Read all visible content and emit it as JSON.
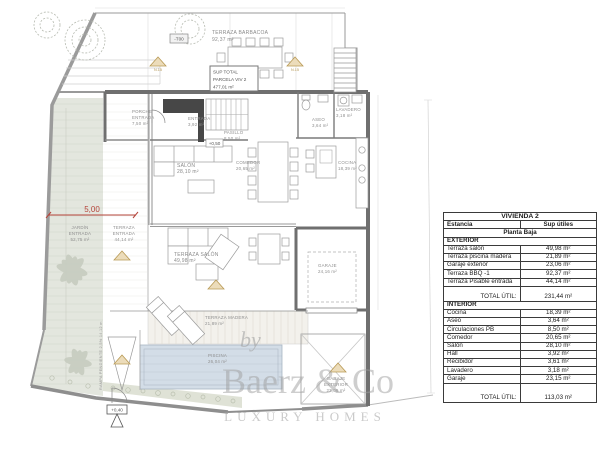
{
  "colors": {
    "wall": "#6f6f6f",
    "garden": "#e3e6de",
    "pool": "#d3dde7",
    "deck": "#f3f1ec",
    "accent_red": "#b5443a",
    "marker_tan": "#ecdcba",
    "marker_tan_edge": "#b99a55"
  },
  "plan": {
    "rooms": {
      "terraza_barbacoa": {
        "name": "TERRAZA BARBACOA",
        "area": "92,37 m²"
      },
      "porche": {
        "l1": "PORCHE",
        "l2": "ENTRADA",
        "area": "7,50 m²"
      },
      "entrada": {
        "name": "ENTRADA",
        "area": "3,92 m²"
      },
      "pasillo": {
        "name": "PASILLO",
        "area": "8,50 m²"
      },
      "salon": {
        "name": "SALÓN",
        "area": "28,10 m²"
      },
      "comedor": {
        "name": "COMEDOR",
        "area": "20,65 m²"
      },
      "cocina": {
        "name": "COCINA",
        "area": "18,39 m²"
      },
      "aseo": {
        "name": "ASEO",
        "area": "3,64 m²"
      },
      "lavadero": {
        "name": "LAVADERO",
        "area": "3,18 m²"
      },
      "jardin_entrada": {
        "l1": "JARDÍN",
        "l2": "ENTRADA",
        "area": "52,75 m²"
      },
      "terraza_entrada": {
        "l1": "TERRAZA",
        "l2": "ENTRADA",
        "area": "44,14 m²"
      },
      "terraza_salon": {
        "name": "TERRAZA SALÓN",
        "area": "49,98 m²"
      },
      "garaje": {
        "name": "GARAJE",
        "area": "24,16 m²"
      },
      "terraza_madera": {
        "name": "TERRAZA MADERA",
        "area": "21,89 m²"
      },
      "piscina": {
        "name": "PISCINA",
        "area": "26,04 m²"
      },
      "garaje_exterior": {
        "l1": "GARAJE",
        "l2": "EXTERIOR",
        "area": "23,06 m²"
      }
    },
    "markers": {
      "t00": "-T00",
      "level_plus050": "+0,50",
      "level_plus040": "+0,40",
      "dim_width": "5,00",
      "north_a": "N.15",
      "north_b": "N.15",
      "ramp_note": "RAMPA PENDIENTE 2,5% 14,12 m",
      "sup_total_l1": "SUP TOTAL",
      "sup_total_l2": "PARCELA VIV 2",
      "sup_total_l3": "477,01 m²"
    }
  },
  "watermark": {
    "by": "by",
    "brand": "Baerz & Co",
    "tagline": "LUXURY HOMES"
  },
  "table": {
    "title": "VIVIENDA 2",
    "col_room": "Estancia",
    "col_area": "Sup útiles",
    "subtitle": "Planta Baja",
    "sections": [
      {
        "header": "EXTERIOR",
        "rows": [
          {
            "name": "Terraza salón",
            "value": "49,98 m²"
          },
          {
            "name": "Terraza piscina madera",
            "value": "21,89 m²"
          },
          {
            "name": "Garaje exterior",
            "value": "23,06 m²"
          },
          {
            "name": "Terraza BBQ -1",
            "value": "92,37 m²"
          },
          {
            "name": "Terraza Pisable entrada",
            "value": "44,14 m²"
          }
        ],
        "total_label": "TOTAL ÚTIL:",
        "total_value": "231,44 m²"
      },
      {
        "header": "INTERIOR",
        "rows": [
          {
            "name": "Cocina",
            "value": "18,39 m²"
          },
          {
            "name": "Aseo",
            "value": "3,64 m²"
          },
          {
            "name": "Circulaciones PB",
            "value": "8,50 m²"
          },
          {
            "name": "Comedor",
            "value": "20,65 m²"
          },
          {
            "name": "Salón",
            "value": "28,10 m²"
          },
          {
            "name": "Hall",
            "value": "3,92 m²"
          },
          {
            "name": "Recibidor",
            "value": "3,61 m²"
          },
          {
            "name": "Lavadero",
            "value": "3,18 m²"
          },
          {
            "name": "Garaje",
            "value": "23,15 m²"
          }
        ],
        "total_label": "TOTAL ÚTIL:",
        "total_value": "113,03 m²"
      }
    ]
  }
}
